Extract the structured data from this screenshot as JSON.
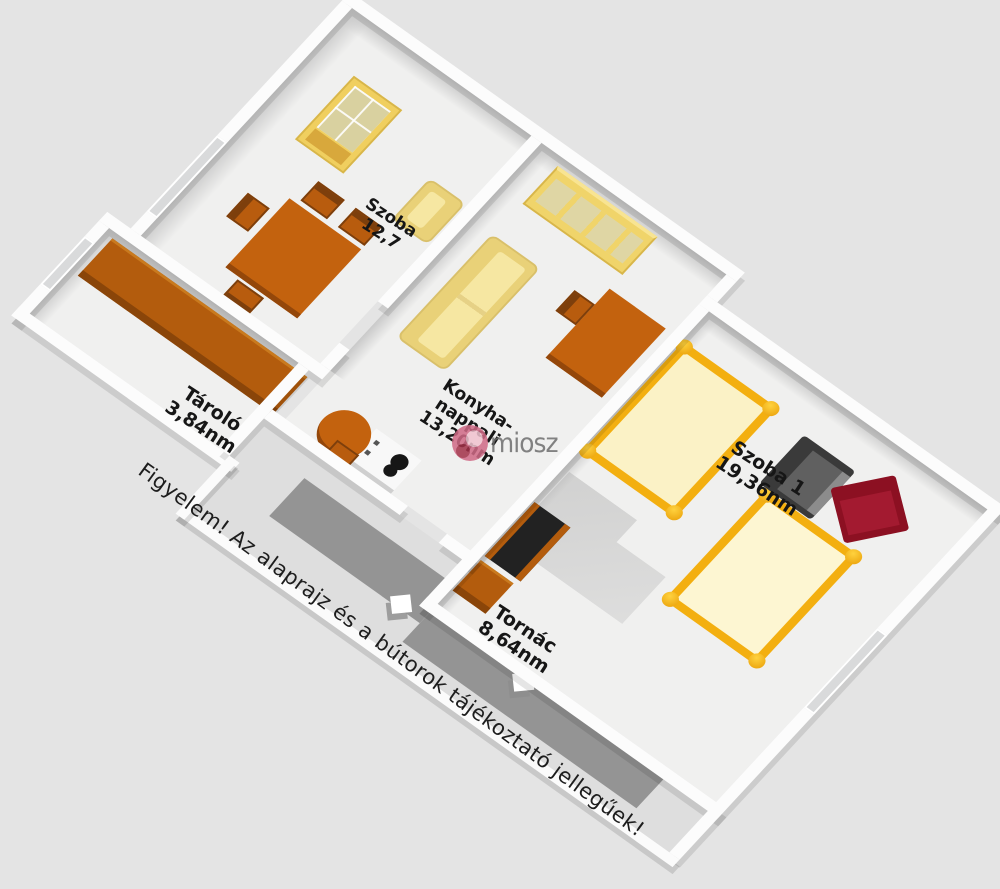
{
  "scene": {
    "width": 1000,
    "height": 889,
    "background": "#e4e4e4"
  },
  "watermark": {
    "brand": "miosz",
    "logo_color": "#d06a86"
  },
  "disclaimer": {
    "text": "Figyelem! Az alaprajz és a bútorok tájékoztató jellegűek!"
  },
  "rooms": {
    "szoba2": {
      "name": "Szoba",
      "area": "12,7"
    },
    "tarolo": {
      "name": "Tároló",
      "area": "3,84nm"
    },
    "konyha": {
      "line1": "Konyha-",
      "line2": "nappali",
      "area": "13,20nm"
    },
    "szoba1": {
      "name": "Szoba 1",
      "area": "19,36nm"
    },
    "tornac": {
      "name": "Tornác",
      "area": "8,64nm"
    }
  },
  "colors": {
    "background": "#e4e4e4",
    "wall": "#fcfcfc",
    "floor": "#f0f0ef",
    "porch_deck": "#949494",
    "wood_furniture": "#c3620e",
    "yellow_furniture": "#f0d46a",
    "sofa_cream": "#f6e7a2",
    "bed_frame": "#f3af10",
    "bed_mattress": "#fbf2c6",
    "armchair_gray": "#3a3a3a",
    "armchair_red": "#8c1022",
    "label_text": "#161616"
  }
}
